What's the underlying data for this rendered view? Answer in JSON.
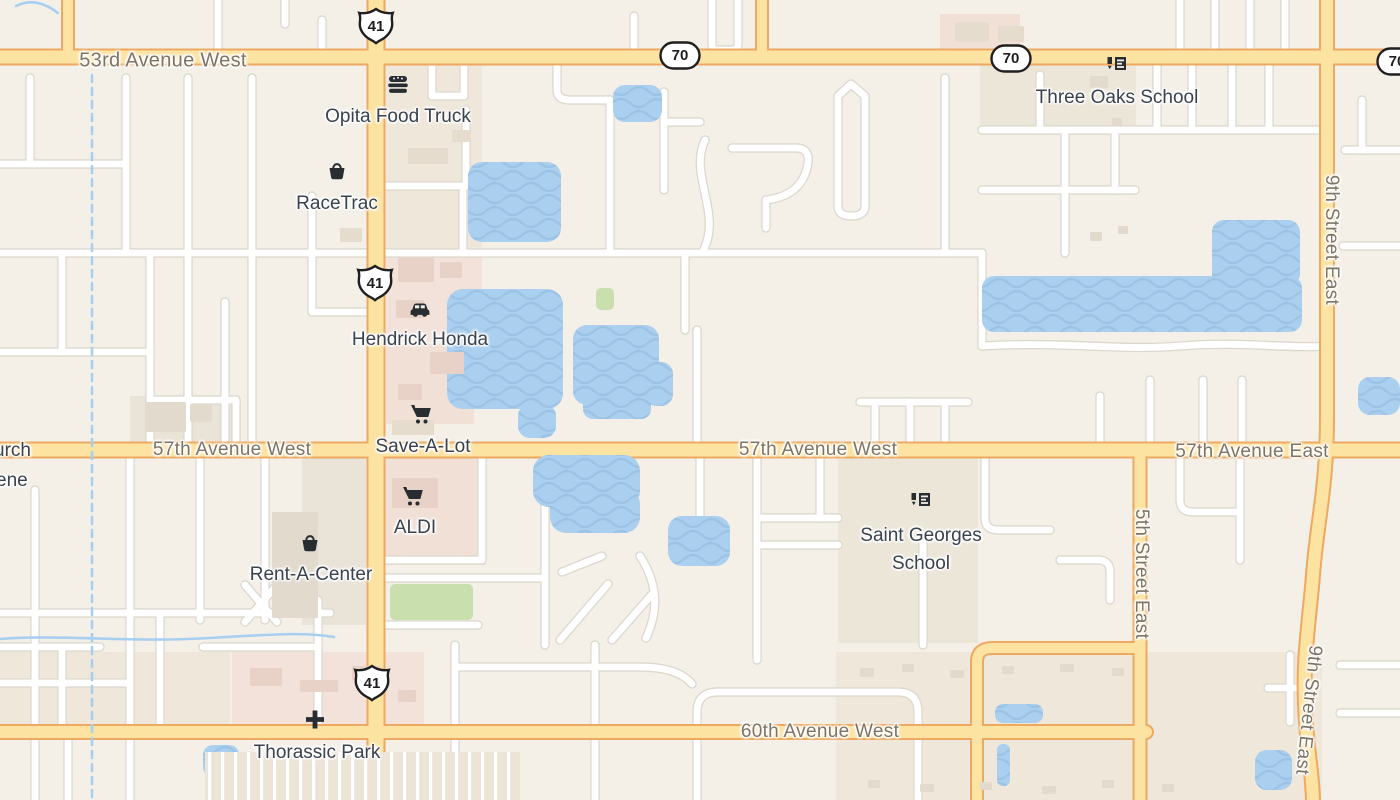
{
  "map": {
    "canvas": {
      "width": 1400,
      "height": 800
    },
    "colors": {
      "land": "#f4f0e8",
      "tan": "#eee7da",
      "tan2": "#ece6d9",
      "pink": "#f3e2da",
      "pink2": "#f0e0d6",
      "gray": "#e9e3d8",
      "green": "#c9dfae",
      "water": "#abcfee",
      "wave": "#9cc3e6",
      "stream": "#a9cff0",
      "minor_fill": "#ffffff",
      "minor_case": "#ddd8ce",
      "major_fill": "#fce3a2",
      "major_case": "#eda961",
      "building": "#e5dccd",
      "building2": "#e2dacd",
      "building_pink": "#e8d2c8",
      "road_text": "#7d7466",
      "poi_text": "#39424d",
      "icon_ink": "#272d31",
      "shield_stroke": "#1f1f1f",
      "stripe_base": "#ece4d6"
    },
    "road_labels": [
      {
        "text": "53rd Avenue West",
        "x": 163,
        "y": 61,
        "size": 20,
        "rot": 0
      },
      {
        "text": "57th Avenue West",
        "x": 232,
        "y": 450,
        "size": 19,
        "rot": 0
      },
      {
        "text": "57th Avenue West",
        "x": 818,
        "y": 450,
        "size": 19,
        "rot": 0
      },
      {
        "text": "57th Avenue East",
        "x": 1252,
        "y": 452,
        "size": 19,
        "rot": 0
      },
      {
        "text": "60th Avenue West",
        "x": 820,
        "y": 732,
        "size": 19,
        "rot": 0
      },
      {
        "text": "9th Street East",
        "x": 1331,
        "y": 240,
        "size": 19,
        "rot": 90
      },
      {
        "text": "5th Street East",
        "x": 1141,
        "y": 574,
        "size": 19,
        "rot": 90
      },
      {
        "text": "9th Street East",
        "x": 1308,
        "y": 710,
        "size": 19,
        "rot": 96
      }
    ],
    "cut_labels": [
      {
        "text": "urch",
        "x": -6,
        "y": 452
      },
      {
        "text": "ene",
        "x": -4,
        "y": 482
      }
    ],
    "shields": [
      {
        "type": "us",
        "text": "41",
        "x": 376,
        "y": 29
      },
      {
        "type": "us",
        "text": "41",
        "x": 375,
        "y": 286
      },
      {
        "type": "us",
        "text": "41",
        "x": 372,
        "y": 686
      },
      {
        "type": "oval",
        "text": "70",
        "x": 680,
        "y": 58
      },
      {
        "type": "oval",
        "text": "70",
        "x": 1011,
        "y": 61
      },
      {
        "type": "oval",
        "text": "70",
        "x": 1397,
        "y": 64
      }
    ],
    "poi": [
      {
        "slug": "opita-food-truck",
        "icon": "burger",
        "ix": 398,
        "iy": 87,
        "lx": 398,
        "ly": 117,
        "lines": [
          "Opita Food Truck"
        ]
      },
      {
        "slug": "racetrac",
        "icon": "basket",
        "ix": 337,
        "iy": 173,
        "lx": 337,
        "ly": 204,
        "lines": [
          "RaceTrac"
        ]
      },
      {
        "slug": "hendrick-honda",
        "icon": "car",
        "ix": 420,
        "iy": 311,
        "lx": 420,
        "ly": 340,
        "lines": [
          "Hendrick Honda"
        ]
      },
      {
        "slug": "save-a-lot",
        "icon": "cart",
        "ix": 421,
        "iy": 417,
        "lx": 423,
        "ly": 447,
        "lines": [
          "Save-A-Lot"
        ]
      },
      {
        "slug": "aldi",
        "icon": "cart",
        "ix": 413,
        "iy": 499,
        "lx": 415,
        "ly": 528,
        "lines": [
          "ALDI"
        ]
      },
      {
        "slug": "rent-a-center",
        "icon": "basket",
        "ix": 310,
        "iy": 545,
        "lx": 311,
        "ly": 575,
        "lines": [
          "Rent-A-Center"
        ]
      },
      {
        "slug": "thorassic-park",
        "icon": "cross",
        "ix": 315,
        "iy": 722,
        "lx": 317,
        "ly": 753,
        "lines": [
          "Thorassic Park"
        ]
      },
      {
        "slug": "three-oaks-school",
        "icon": "school",
        "ix": 1117,
        "iy": 68,
        "lx": 1117,
        "ly": 98,
        "lines": [
          "Three Oaks School"
        ]
      },
      {
        "slug": "saint-georges-school",
        "icon": "school",
        "ix": 921,
        "iy": 504,
        "lx": 921,
        "ly": 550,
        "lines": [
          "Saint Georges",
          "School"
        ]
      }
    ],
    "geometry": {
      "blocks": [
        [
          386,
          64,
          96,
          188,
          "tan"
        ],
        [
          386,
          250,
          96,
          92,
          "pink"
        ],
        [
          386,
          344,
          88,
          80,
          "pink2"
        ],
        [
          302,
          457,
          64,
          168,
          "gray"
        ],
        [
          382,
          457,
          104,
          108,
          "pink2"
        ],
        [
          232,
          652,
          192,
          74,
          "pink"
        ],
        [
          0,
          652,
          230,
          74,
          "tan"
        ],
        [
          836,
          652,
          486,
          148,
          "tan"
        ],
        [
          980,
          64,
          156,
          64,
          "tan2"
        ],
        [
          838,
          457,
          140,
          186,
          "tan2"
        ],
        [
          130,
          396,
          108,
          47,
          "gray"
        ],
        [
          940,
          14,
          80,
          36,
          "pink2"
        ]
      ],
      "green": [
        [
          390,
          584,
          83,
          36
        ],
        [
          596,
          288,
          18,
          22
        ]
      ],
      "roads_major": [
        {
          "d": "M0,57 H1400",
          "w": 13
        },
        {
          "d": "M0,450 H1400",
          "w": 13
        },
        {
          "d": "M0,732 H1146",
          "w": 12
        },
        {
          "d": "M376,0 V800",
          "w": 15
        },
        {
          "d": "M1327,0 V415 C1327,490 1317,520 1313,575 C1309,625 1303,655 1305,705 C1307,755 1312,765 1313,800",
          "w": 12
        },
        {
          "d": "M1140,450 V800",
          "w": 11
        },
        {
          "d": "M977,800 V662 Q977,648 992,648 H1140",
          "w": 10
        },
        {
          "d": "M68,0 V57",
          "w": 10
        },
        {
          "d": "M762,0 V57",
          "w": 10
        }
      ],
      "roads_minor": [
        "M30,78 V162",
        "M0,164 H126",
        "M126,78 V253",
        "M188,78 V443",
        "M252,78 V443",
        "M312,196 V253",
        "M0,253 H982",
        "M62,253 V352",
        "M0,352 H150",
        "M150,253 V443",
        "M225,302 V443",
        "M312,253 V312 H366",
        "M218,0 V57",
        "M285,0 V24",
        "M322,20 V57",
        "M634,16 V57",
        "M712,0 V44 Q712,50 718,50 H732 Q738,50 738,44 V0",
        "M432,64 V96 H464 V64",
        "M557,64 V90 Q557,100 570,100 H610",
        "M610,100 V253",
        "M386,186 H463",
        "M463,186 V253",
        "M466,110 V186",
        "M664,92 V190",
        "M664,122 H700",
        "M705,140 C688,176 724,214 702,253",
        "M732,148 H796 Q812,148 807,168 Q800,196 766,200",
        "M766,200 V228",
        "M851,84 L838,96 V206 Q838,216 851,216 Q865,216 865,206 V96 L851,84 Z",
        "M945,78 V253",
        "M685,253 V330",
        "M697,330 V443",
        "M860,402 H968",
        "M875,404 V443",
        "M910,402 V443",
        "M945,404 V443",
        "M982,130 H1322",
        "M1040,75 V130",
        "M982,190 H1135",
        "M1065,130 V253",
        "M1115,130 V190",
        "M1157,64 V130",
        "M1192,64 V130",
        "M1232,64 V130",
        "M1269,64 V130",
        "M1180,0 V52",
        "M1215,0 V52",
        "M1250,0 V52",
        "M1285,0 V52",
        "M982,253 V346",
        "M982,346 C1060,341 1120,351 1180,346 S1290,349 1327,346",
        "M1203,380 V443",
        "M1150,380 V443",
        "M1242,380 V443",
        "M1100,396 V443",
        "M1345,150 H1400",
        "M1362,100 V150",
        "M1343,246 H1400",
        "M985,457 V518 Q985,530 998,530 H1050",
        "M1060,560 H1098 Q1110,560 1110,572 V600",
        "M1180,457 V500 Q1180,512 1193,512 H1240",
        "M1240,457 V560",
        "M923,543 V645",
        "M1290,655 V722",
        "M1268,688 H1314",
        "M1340,665 H1400",
        "M1340,713 H1400",
        "M545,457 V560",
        "M482,457 V560",
        "M386,560 H482",
        "M386,578 H545",
        "M386,625 H478",
        "M545,560 V645",
        "M455,645 V800",
        "M455,667 H640 Q678,667 692,684",
        "M697,800 V712 Q697,692 718,692 H898 Q918,692 918,712 V800",
        "M560,640 L608,584",
        "M612,640 L654,592",
        "M640,556 Q666,596 646,638",
        "M562,572 L602,556",
        "M700,457 V520",
        "M757,457 V660",
        "M757,518 H838",
        "M757,545 H838",
        "M820,457 V518",
        "M35,490 V800",
        "M130,457 V726",
        "M200,457 V620",
        "M265,457 V620",
        "M0,613 H330",
        "M245,585 L277,622",
        "M277,585 L245,622",
        "M318,600 V726",
        "M0,647 H100",
        "M62,647 V726",
        "M160,613 V726",
        "M203,647 H318",
        "M0,683 H130",
        "M130,740 V800",
        "M68,740 V800",
        "M595,645 V800",
        "M150,400 H236",
        "M236,400 V443"
      ],
      "streams": [
        {
          "d": "M92,75 V800",
          "dash": true
        },
        {
          "d": "M0,639 C60,634 130,643 210,638 S310,633 334,637",
          "dash": false
        },
        {
          "d": "M16,6 Q36,-4 58,13",
          "dash": false
        }
      ],
      "water": [
        [
          613,
          85,
          49,
          37,
          12
        ],
        [
          468,
          162,
          93,
          80,
          14
        ],
        [
          447,
          289,
          116,
          120,
          16
        ],
        [
          573,
          325,
          86,
          80,
          14
        ],
        [
          645,
          362,
          28,
          44,
          12
        ],
        [
          518,
          404,
          38,
          34,
          12
        ],
        [
          583,
          395,
          68,
          24,
          10
        ],
        [
          533,
          455,
          107,
          52,
          16
        ],
        [
          550,
          488,
          90,
          45,
          16
        ],
        [
          668,
          516,
          62,
          50,
          14
        ],
        [
          982,
          276,
          320,
          56,
          12
        ],
        [
          1212,
          220,
          88,
          66,
          12
        ],
        [
          1358,
          377,
          42,
          38,
          12
        ],
        [
          995,
          704,
          48,
          19,
          8
        ],
        [
          997,
          744,
          13,
          42,
          6
        ],
        [
          203,
          745,
          36,
          32,
          10
        ],
        [
          1255,
          750,
          37,
          40,
          12
        ]
      ],
      "buildings": [
        [
          408,
          148,
          40,
          16,
          "b"
        ],
        [
          452,
          130,
          18,
          12,
          "b"
        ],
        [
          340,
          228,
          22,
          14,
          "b"
        ],
        [
          398,
          258,
          36,
          24,
          "p"
        ],
        [
          440,
          262,
          22,
          16,
          "p"
        ],
        [
          396,
          300,
          28,
          18,
          "p"
        ],
        [
          430,
          352,
          34,
          22,
          "p"
        ],
        [
          398,
          384,
          24,
          16,
          "p"
        ],
        [
          392,
          420,
          42,
          15,
          "b"
        ],
        [
          392,
          478,
          46,
          30,
          "p"
        ],
        [
          272,
          512,
          46,
          106,
          "g"
        ],
        [
          146,
          402,
          40,
          30,
          "g"
        ],
        [
          190,
          404,
          22,
          18,
          "g"
        ],
        [
          1090,
          76,
          18,
          12,
          "g"
        ],
        [
          1112,
          118,
          10,
          8,
          "g"
        ],
        [
          1118,
          226,
          10,
          8,
          "g"
        ],
        [
          1090,
          232,
          12,
          9,
          "g"
        ],
        [
          250,
          668,
          32,
          18,
          "p"
        ],
        [
          300,
          680,
          38,
          12,
          "p"
        ],
        [
          352,
          666,
          28,
          14,
          "p"
        ],
        [
          398,
          690,
          18,
          12,
          "p"
        ],
        [
          860,
          668,
          14,
          9,
          "g"
        ],
        [
          902,
          664,
          12,
          8,
          "g"
        ],
        [
          950,
          670,
          14,
          8,
          "g"
        ],
        [
          1002,
          666,
          12,
          8,
          "g"
        ],
        [
          1060,
          664,
          14,
          8,
          "g"
        ],
        [
          1112,
          668,
          12,
          8,
          "g"
        ],
        [
          868,
          780,
          12,
          8,
          "g"
        ],
        [
          920,
          784,
          14,
          8,
          "g"
        ],
        [
          980,
          782,
          12,
          8,
          "g"
        ],
        [
          1042,
          786,
          14,
          8,
          "g"
        ],
        [
          1102,
          780,
          12,
          8,
          "g"
        ],
        [
          1162,
          784,
          12,
          8,
          "g"
        ],
        [
          955,
          22,
          34,
          20,
          "b"
        ],
        [
          998,
          26,
          26,
          16,
          "b"
        ]
      ],
      "stripe_areas": [
        [
          205,
          752,
          315,
          48
        ]
      ]
    }
  }
}
